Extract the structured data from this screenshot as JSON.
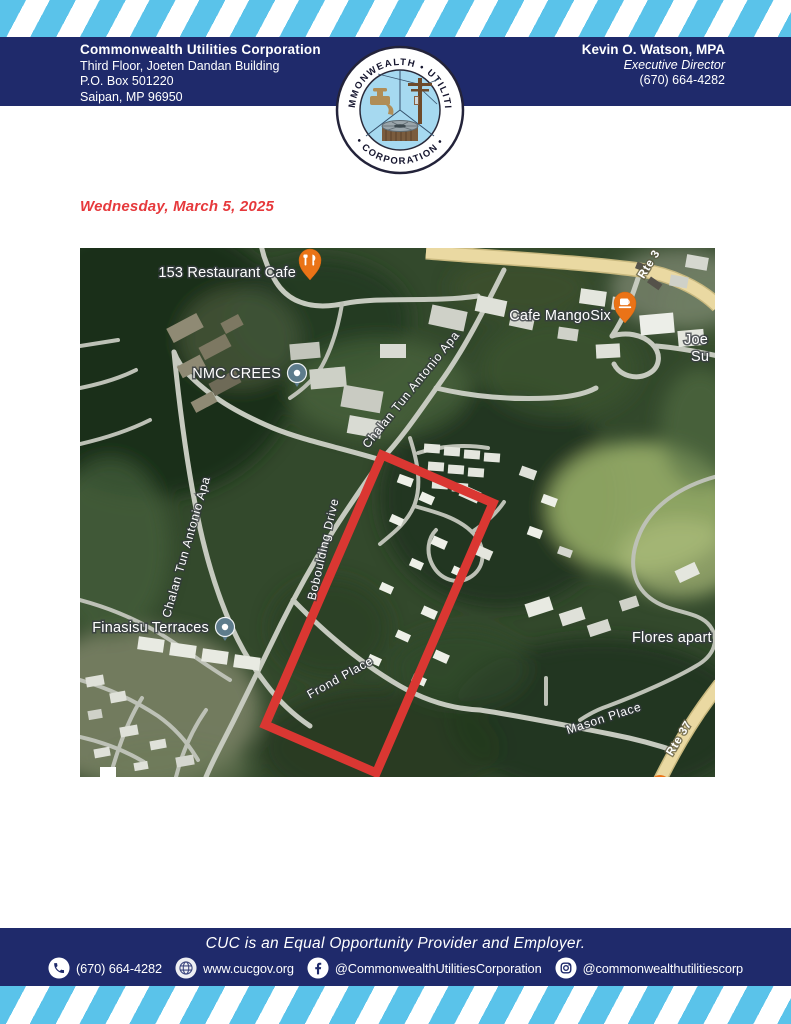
{
  "colors": {
    "navy": "#1f2a6b",
    "stripe_blue": "#5ac3ea",
    "accent_red": "#e6393c",
    "map_boundary_red": "#da3732",
    "road_yellow": "#ead9a2",
    "pin_orange": "#ea7317",
    "pin_slate": "#5d7c8c"
  },
  "header": {
    "org_name": "Commonwealth Utilities Corporation",
    "address_line1": "Third Floor, Joeten Dandan Building",
    "address_line2": "P.O. Box 501220",
    "address_line3": "Saipan, MP 96950",
    "contact_name": "Kevin O. Watson, MPA",
    "contact_title": "Executive Director",
    "contact_phone": "(670) 664-4282"
  },
  "logo": {
    "arc_top": "COMMONWEALTH • UTILITIES",
    "arc_bottom": "• CORPORATION •"
  },
  "date_line": "Wednesday, March 5, 2025",
  "map": {
    "pois": [
      {
        "name": "153 Restaurant Cafe",
        "pin": "restaurant-pin-orange"
      },
      {
        "name": "Cafe MangoSix",
        "pin": "cafe-pin-orange"
      },
      {
        "name": "NMC CREES",
        "pin": "generic-slate-dot"
      },
      {
        "name": "Finasisu Terraces",
        "pin": "generic-slate-dot"
      },
      {
        "name": "Flores apart",
        "pin": "none"
      },
      {
        "name": "Joe",
        "pin": "none"
      },
      {
        "name": "Su",
        "pin": "none"
      }
    ],
    "streets": [
      "Chalan Tun Antonio Apa",
      "Chalan Tun Antonio Apa",
      "Boboulding Drive",
      "Frond Place",
      "Mason Place",
      "Rte 37",
      "Rte 3"
    ]
  },
  "footer": {
    "eeo_line": "CUC is an Equal Opportunity Provider and Employer.",
    "contacts": [
      {
        "icon": "phone-icon",
        "label": "(670) 664-4282"
      },
      {
        "icon": "globe-icon",
        "label": "www.cucgov.org"
      },
      {
        "icon": "facebook-icon",
        "label": "@CommonwealthUtilitiesCorporation"
      },
      {
        "icon": "instagram-icon",
        "label": "@commonwealthutilitiescorp"
      }
    ]
  }
}
